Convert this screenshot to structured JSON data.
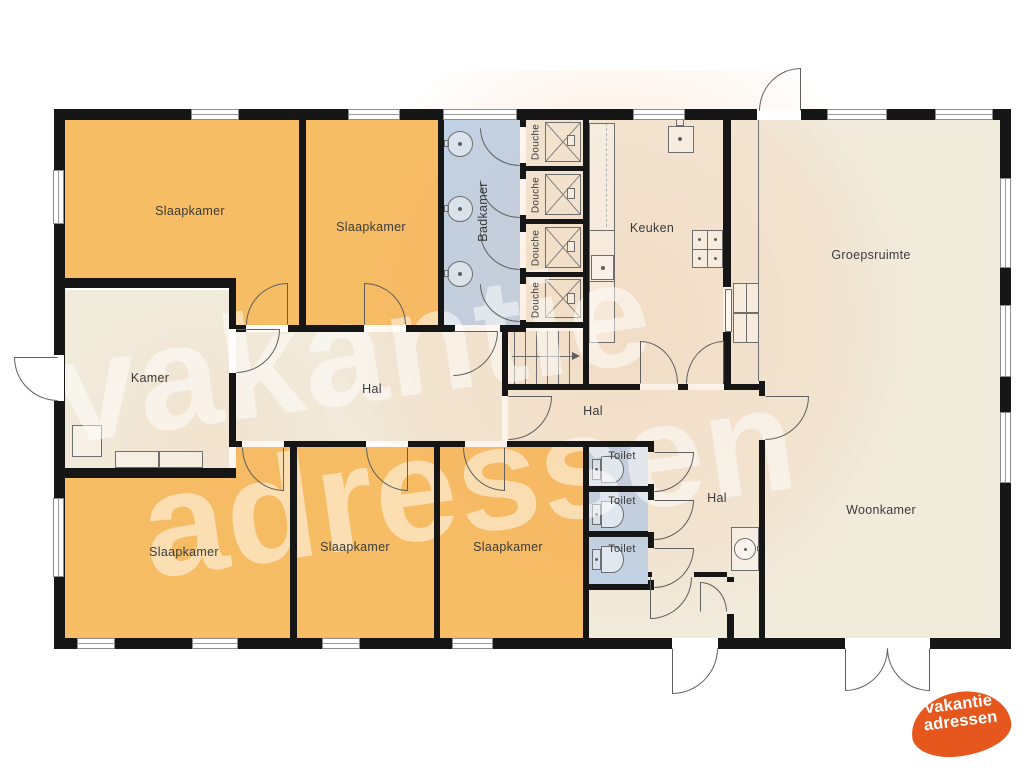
{
  "title": "Plattegrond vakantiehuis (begane grond)",
  "colors": {
    "bedroom_orange": "#f6bd64",
    "common_beige": "#f1ebdc",
    "sanitary_blue": "#bcd5ee",
    "wall_black": "#161616",
    "logo_orange": "#e5571d",
    "watermark_tint": "rgba(245,164,105,0.20)"
  },
  "floorplan": {
    "rooms": [
      {
        "id": "slaapkamer-1",
        "label": "Slaapkamer"
      },
      {
        "id": "slaapkamer-2",
        "label": "Slaapkamer"
      },
      {
        "id": "badkamer",
        "label": "Badkamer"
      },
      {
        "id": "douche-1",
        "label": "Douche"
      },
      {
        "id": "douche-2",
        "label": "Douche"
      },
      {
        "id": "douche-3",
        "label": "Douche"
      },
      {
        "id": "douche-4",
        "label": "Douche"
      },
      {
        "id": "keuken",
        "label": "Keuken"
      },
      {
        "id": "groepsruimte",
        "label": "Groepsruimte"
      },
      {
        "id": "kamer",
        "label": "Kamer"
      },
      {
        "id": "hal-1",
        "label": "Hal"
      },
      {
        "id": "hal-2",
        "label": "Hal"
      },
      {
        "id": "hal-3",
        "label": "Hal"
      },
      {
        "id": "toilet-1",
        "label": "Toilet"
      },
      {
        "id": "toilet-2",
        "label": "Toilet"
      },
      {
        "id": "toilet-3",
        "label": "Toilet"
      },
      {
        "id": "woonkamer",
        "label": "Woonkamer"
      },
      {
        "id": "slaapkamer-3",
        "label": "Slaapkamer"
      },
      {
        "id": "slaapkamer-4",
        "label": "Slaapkamer"
      },
      {
        "id": "slaapkamer-5",
        "label": "Slaapkamer"
      }
    ]
  },
  "watermark": {
    "line1": "vakantie",
    "line2": "adressen"
  },
  "logo": {
    "line1": "vakantie",
    "line2": "adressen"
  }
}
